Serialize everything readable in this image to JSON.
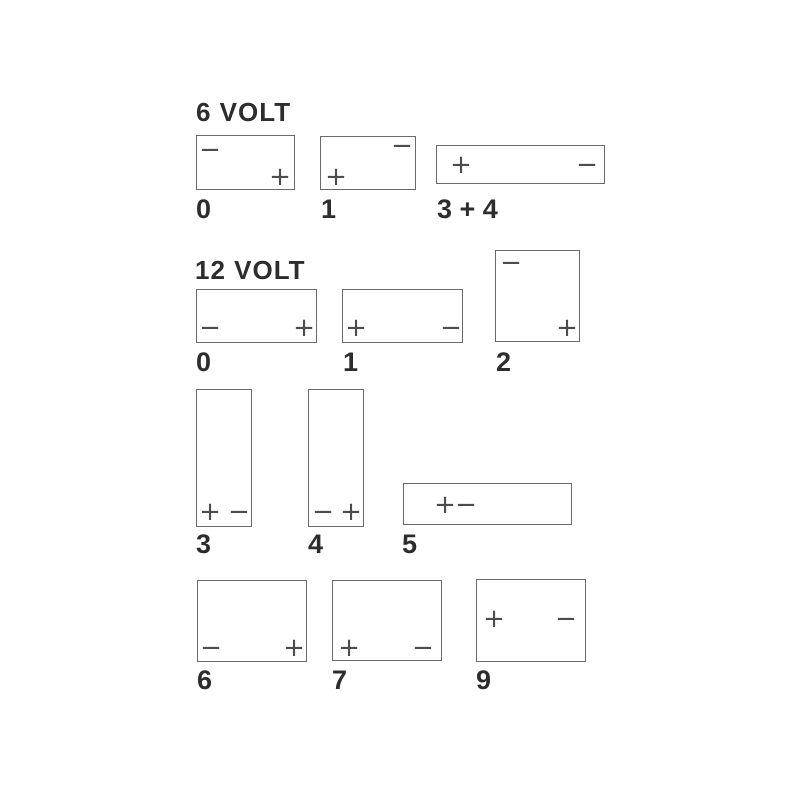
{
  "colors": {
    "background": "#ffffff",
    "outline": "#6a6a6a",
    "text": "#2d2d2d",
    "terminal_symbol": "#4c4c4c"
  },
  "sections": [
    {
      "title": "6 VOLT",
      "items": [
        {
          "label": "0",
          "terminals": [
            {
              "sign": "−",
              "position": "top-left"
            },
            {
              "sign": "+",
              "position": "bottom-right"
            }
          ]
        },
        {
          "label": "1",
          "terminals": [
            {
              "sign": "−",
              "position": "top-right"
            },
            {
              "sign": "+",
              "position": "bottom-left"
            }
          ]
        },
        {
          "label": "3 + 4",
          "terminals": [
            {
              "sign": "+",
              "position": "middle-left"
            },
            {
              "sign": "−",
              "position": "middle-right"
            }
          ]
        }
      ]
    },
    {
      "title": "12 VOLT",
      "items": [
        {
          "label": "0",
          "terminals": [
            {
              "sign": "−",
              "position": "bottom-left"
            },
            {
              "sign": "+",
              "position": "bottom-right"
            }
          ]
        },
        {
          "label": "1",
          "terminals": [
            {
              "sign": "+",
              "position": "bottom-left"
            },
            {
              "sign": "−",
              "position": "bottom-right"
            }
          ]
        },
        {
          "label": "2",
          "terminals": [
            {
              "sign": "−",
              "position": "top-left"
            },
            {
              "sign": "+",
              "position": "bottom-right"
            }
          ]
        },
        {
          "label": "3",
          "terminals": [
            {
              "sign": "+",
              "position": "bottom-left"
            },
            {
              "sign": "−",
              "position": "bottom-right"
            }
          ]
        },
        {
          "label": "4",
          "terminals": [
            {
              "sign": "−",
              "position": "bottom-left"
            },
            {
              "sign": "+",
              "position": "bottom-right"
            }
          ]
        },
        {
          "label": "5",
          "terminals": [
            {
              "sign": "+",
              "position": "middle-left"
            },
            {
              "sign": "−",
              "position": "middle-left-2"
            }
          ]
        },
        {
          "label": "6",
          "terminals": [
            {
              "sign": "−",
              "position": "bottom-left"
            },
            {
              "sign": "+",
              "position": "bottom-right"
            }
          ]
        },
        {
          "label": "7",
          "terminals": [
            {
              "sign": "+",
              "position": "bottom-left"
            },
            {
              "sign": "−",
              "position": "bottom-right"
            }
          ]
        },
        {
          "label": "9",
          "terminals": [
            {
              "sign": "+",
              "position": "middle-left"
            },
            {
              "sign": "−",
              "position": "middle-right"
            }
          ]
        }
      ]
    }
  ]
}
